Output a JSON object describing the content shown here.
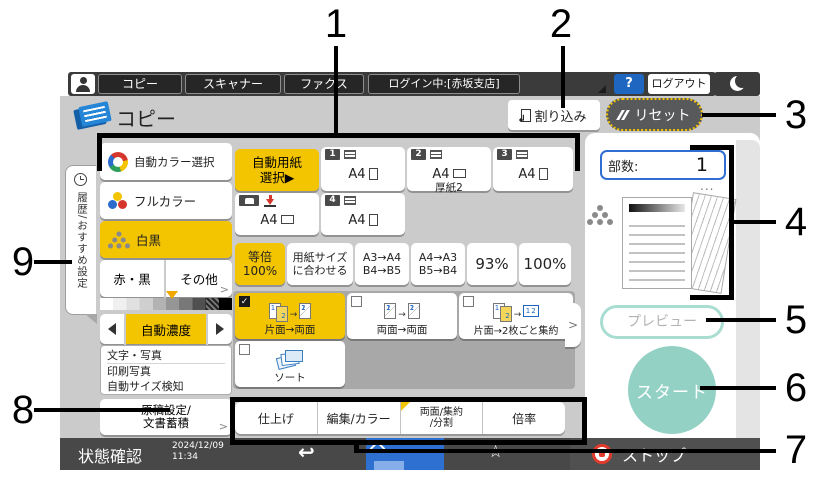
{
  "callouts": {
    "labels": [
      "1",
      "2",
      "3",
      "4",
      "5",
      "6",
      "7",
      "8",
      "9"
    ]
  },
  "top_bar": {
    "tabs": [
      {
        "label": "コピー"
      },
      {
        "label": "スキャナー"
      },
      {
        "label": "ファクス"
      }
    ],
    "login_status": "ログイン中:[赤坂支店]",
    "help_label": "?",
    "logout_label": "ログアウト"
  },
  "header": {
    "title": "コピー",
    "interrupt_label": "割り込み",
    "reset_label": "リセット"
  },
  "sidebar": {
    "tab_label": "履歴/おすすめ設定"
  },
  "color_modes": {
    "auto": "自動カラー選択",
    "full_color": "フルカラー",
    "bw": "白黒",
    "red_black": "赤・黒",
    "other": "その他",
    "selected": "白黒"
  },
  "density": {
    "auto_label": "自動濃度"
  },
  "original": {
    "types": [
      "文字・写真",
      "印刷写真",
      "自動サイズ検知"
    ],
    "settings_line1": "原稿設定/",
    "settings_line2": "文書蓄積"
  },
  "paper": {
    "auto_line1": "自動用紙",
    "auto_line2": "選択▶",
    "trays": [
      {
        "no": "1",
        "size": "A4",
        "note": ""
      },
      {
        "no": "2",
        "size": "A4",
        "note": "厚紙2"
      },
      {
        "no": "3",
        "size": "A4",
        "note": ""
      },
      {
        "no": "4",
        "size": "A4",
        "note": ""
      }
    ],
    "bypass_size": "A4"
  },
  "ratio": {
    "items": [
      {
        "line1": "等倍",
        "line2": "100%",
        "selected": true
      },
      {
        "line1": "用紙サイズ",
        "line2": "に合わせる",
        "selected": false
      },
      {
        "line1": "A3→A4",
        "line2": "B4→B5",
        "selected": false
      },
      {
        "line1": "A4→A3",
        "line2": "B5→B4",
        "selected": false
      },
      {
        "line1": "93%",
        "line2": "",
        "selected": false
      },
      {
        "line1": "100%",
        "line2": "",
        "selected": false
      }
    ]
  },
  "duplex": {
    "items": [
      {
        "label": "片面→両面",
        "checked": true
      },
      {
        "label": "両面→両面",
        "checked": false
      },
      {
        "label": "片面→2枚ごと集約",
        "checked": false
      },
      {
        "label": "ソート",
        "checked": false
      }
    ]
  },
  "feature_tabs": [
    {
      "line1": "仕上げ",
      "line2": "",
      "modified": false
    },
    {
      "line1": "編集/カラー",
      "line2": "",
      "modified": false
    },
    {
      "line1": "両面/集約",
      "line2": "/分割",
      "modified": true
    },
    {
      "line1": "倍率",
      "line2": "",
      "modified": false
    }
  ],
  "right_panel": {
    "copies_label": "部数:",
    "copies_value": "1",
    "more_dots": "...",
    "preview_label": "プレビュー",
    "start_label": "スタート"
  },
  "status_bar": {
    "status_label": "状態確認",
    "date": "2024/12/09",
    "time": "11:34",
    "stop_label": "ストップ"
  },
  "colors": {
    "accent_yellow": "#f3c400",
    "start_teal": "#93d1c5",
    "link_blue": "#2f6ed2",
    "stop_red": "#e23b2e",
    "screen_gray": "#cbcbcb"
  }
}
